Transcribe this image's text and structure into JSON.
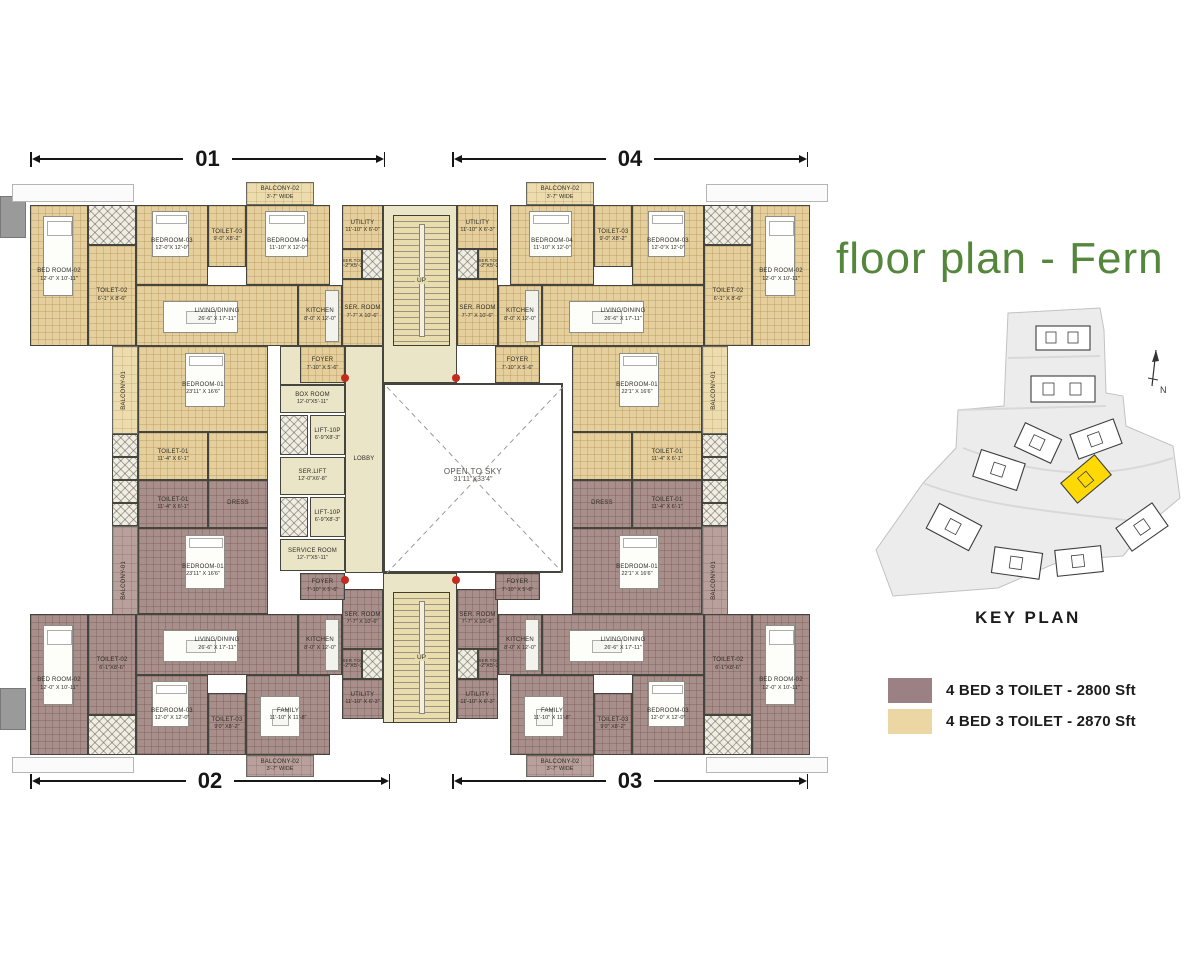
{
  "title": "floor plan - Fern",
  "title_color": "#54863c",
  "dims": {
    "top_left": "01",
    "top_right": "04",
    "bottom_left": "02",
    "bottom_right": "03"
  },
  "courtyard": {
    "name": "OPEN TO SKY",
    "dims": "31'11\"X33'4\""
  },
  "stairs_label": "UP",
  "key_plan": {
    "label": "KEY PLAN",
    "north": "N",
    "highlight_color": "#ffd903"
  },
  "legend": [
    {
      "color": "#9b8184",
      "label": "4 BED  3 TOILET -  2800 Sft"
    },
    {
      "color": "#ecd7a4",
      "label": "4 BED 3 TOILET -  2870 Sft"
    }
  ],
  "plan": {
    "rooms": [
      {
        "id": "terrace-top-left",
        "x": 12,
        "y": 184,
        "w": 122,
        "h": 18,
        "c": "ledge"
      },
      {
        "id": "terrace-top-right",
        "x": 706,
        "y": 184,
        "w": 122,
        "h": 18,
        "c": "ledge"
      },
      {
        "id": "terrace-bottom-left",
        "x": 12,
        "y": 757,
        "w": 122,
        "h": 16,
        "c": "ledge"
      },
      {
        "id": "terrace-bottom-right",
        "x": 706,
        "y": 757,
        "w": 122,
        "h": 16,
        "c": "ledge"
      },
      {
        "id": "wall-stub-left-top",
        "x": 0,
        "y": 196,
        "w": 26,
        "h": 42,
        "c": "graystub"
      },
      {
        "id": "wall-stub-left-bottom",
        "x": 0,
        "y": 688,
        "w": 26,
        "h": 42,
        "c": "graystub"
      },
      {
        "id": "core-top",
        "x": 383,
        "y": 205,
        "w": 74,
        "h": 178,
        "c": "cream"
      },
      {
        "id": "core-bottom",
        "x": 383,
        "y": 573,
        "w": 74,
        "h": 150,
        "c": "cream"
      },
      {
        "id": "lift-corridor",
        "x": 280,
        "y": 346,
        "w": 65,
        "h": 39,
        "c": "cream"
      },
      {
        "id": "u01-bed-room-02",
        "n": "BED ROOM-02",
        "d": "12'-0\" X 10'-11\"",
        "x": 30,
        "y": 205,
        "w": 58,
        "h": 141,
        "c": "tan",
        "f": "bed"
      },
      {
        "id": "u01-duct",
        "x": 88,
        "y": 205,
        "w": 48,
        "h": 40,
        "c": "hatch"
      },
      {
        "id": "u01-toilet-02",
        "n": "TOILET-02",
        "d": "6'-1\" X 8'-6\"",
        "x": 88,
        "y": 245,
        "w": 48,
        "h": 101,
        "c": "tan"
      },
      {
        "id": "u01-bedroom-03",
        "n": "BEDROOM-03",
        "d": "12'-0\"X 12'-0\"",
        "x": 136,
        "y": 205,
        "w": 72,
        "h": 80,
        "c": "tan",
        "f": "bed"
      },
      {
        "id": "u01-toilet-03",
        "n": "TOILET-03",
        "d": "9'-0\" X8'-2\"",
        "x": 208,
        "y": 205,
        "w": 38,
        "h": 62,
        "c": "tan"
      },
      {
        "id": "u01-bedroom-04",
        "n": "BEDROOM-04",
        "d": "11'-10\" X 12'-0\"",
        "x": 246,
        "y": 205,
        "w": 84,
        "h": 80,
        "c": "tan",
        "f": "bed"
      },
      {
        "id": "u01-balcony-02",
        "n": "BALCONY-02",
        "d": "3'-7\" WIDE",
        "x": 246,
        "y": 182,
        "w": 68,
        "h": 23,
        "c": "tanl"
      },
      {
        "id": "u01-living-dining",
        "n": "LIVING/DINING",
        "d": "26'-6\" X 17'-11\"",
        "x": 136,
        "y": 285,
        "w": 162,
        "h": 61,
        "c": "tan",
        "f": "sofa"
      },
      {
        "id": "u01-kitchen",
        "n": "KITCHEN",
        "d": "8'-0\" X 12'-0\"",
        "x": 298,
        "y": 285,
        "w": 44,
        "h": 61,
        "c": "tan",
        "f": "counter"
      },
      {
        "id": "u01-utility",
        "n": "UTILITY",
        "d": "11'-10\" X 6'-0\"",
        "x": 342,
        "y": 205,
        "w": 41,
        "h": 44,
        "c": "tan"
      },
      {
        "id": "u01-ser-toi",
        "n": "SER.TOI",
        "d": "2'-2\"X5'-2\"",
        "x": 342,
        "y": 249,
        "w": 20,
        "h": 30,
        "c": "tan tiny"
      },
      {
        "id": "u01-duct-2",
        "x": 362,
        "y": 249,
        "w": 21,
        "h": 30,
        "c": "hatch"
      },
      {
        "id": "u01-ser-room",
        "n": "SER. ROOM",
        "d": "7'-7\" X 10'-6\"",
        "x": 342,
        "y": 279,
        "w": 41,
        "h": 67,
        "c": "tan"
      },
      {
        "id": "u01-foyer",
        "n": "FOYER",
        "d": "7'-10\" X 5'-6\"",
        "x": 300,
        "y": 346,
        "w": 45,
        "h": 37,
        "c": "tan"
      },
      {
        "id": "u01-bedroom-01",
        "n": "BEDROOM-01",
        "d": "23'11\" X 16'6\"",
        "x": 138,
        "y": 346,
        "w": 130,
        "h": 86,
        "c": "tan",
        "f": "bedw"
      },
      {
        "id": "u01-toilet-01",
        "n": "TOILET-01",
        "d": "11'-4\" X 6'-1\"",
        "x": 138,
        "y": 432,
        "w": 70,
        "h": 48,
        "c": "tan"
      },
      {
        "id": "u01-wardrobe",
        "x": 208,
        "y": 432,
        "w": 60,
        "h": 48,
        "c": "tan"
      },
      {
        "id": "u01-balcony-01",
        "n": "BALCONY-01",
        "x": 112,
        "y": 346,
        "w": 26,
        "h": 88,
        "c": "tanl",
        "v": true
      },
      {
        "id": "u01-shaft-a",
        "x": 112,
        "y": 434,
        "w": 26,
        "h": 23,
        "c": "hatch"
      },
      {
        "id": "u01-shaft-b",
        "x": 112,
        "y": 457,
        "w": 26,
        "h": 23,
        "c": "hatch"
      },
      {
        "id": "u02-toilet-01",
        "n": "TOILET-01",
        "d": "11'-4\" X 6'-1\"",
        "x": 138,
        "y": 480,
        "w": 70,
        "h": 48,
        "c": "mauve"
      },
      {
        "id": "u02-dress",
        "n": "DRESS",
        "x": 208,
        "y": 480,
        "w": 60,
        "h": 48,
        "c": "mauve"
      },
      {
        "id": "u02-shaft-a",
        "x": 112,
        "y": 480,
        "w": 26,
        "h": 23,
        "c": "hatch"
      },
      {
        "id": "u02-shaft-b",
        "x": 112,
        "y": 503,
        "w": 26,
        "h": 23,
        "c": "hatch"
      },
      {
        "id": "u02-bedroom-01",
        "n": "BEDROOM-01",
        "d": "23'11\" X 16'6\"",
        "x": 138,
        "y": 528,
        "w": 130,
        "h": 86,
        "c": "mauve",
        "f": "bedw"
      },
      {
        "id": "u02-balcony-01",
        "n": "BALCONY-01",
        "x": 112,
        "y": 526,
        "w": 26,
        "h": 108,
        "c": "mauvel",
        "v": true
      },
      {
        "id": "u02-living-dining",
        "n": "LIVING/DINING",
        "d": "26'-6\" X 17'-11\"",
        "x": 136,
        "y": 614,
        "w": 162,
        "h": 61,
        "c": "mauve",
        "f": "sofa"
      },
      {
        "id": "u02-kitchen",
        "n": "KITCHEN",
        "d": "8'-0\" X 12'-0\"",
        "x": 298,
        "y": 614,
        "w": 44,
        "h": 61,
        "c": "mauve",
        "f": "counter"
      },
      {
        "id": "u02-bedroom-03",
        "n": "BEDROOM-03",
        "d": "12'-0\" X 12'-0\"",
        "x": 136,
        "y": 675,
        "w": 72,
        "h": 80,
        "c": "mauve",
        "f": "bed"
      },
      {
        "id": "u02-toilet-03",
        "n": "TOILET-03",
        "d": "9'0\" X8'-2\"",
        "x": 208,
        "y": 693,
        "w": 38,
        "h": 62,
        "c": "mauve"
      },
      {
        "id": "u02-family",
        "n": "FAMILY",
        "d": "11'-10\" X 11'-8\"",
        "x": 246,
        "y": 675,
        "w": 84,
        "h": 80,
        "c": "mauve",
        "f": "sofa"
      },
      {
        "id": "u02-balcony-02",
        "n": "BALCONY-02",
        "d": "3'-7\" WIDE",
        "x": 246,
        "y": 755,
        "w": 68,
        "h": 22,
        "c": "mauvel"
      },
      {
        "id": "u02-bed-room-02",
        "n": "BED ROOM-02",
        "d": "12'-0\" X 10'-11\"",
        "x": 30,
        "y": 614,
        "w": 58,
        "h": 141,
        "c": "mauve",
        "f": "bed"
      },
      {
        "id": "u02-toilet-02",
        "n": "TOILET-02",
        "d": "6'-1\"X8'-6\"",
        "x": 88,
        "y": 614,
        "w": 48,
        "h": 101,
        "c": "mauve"
      },
      {
        "id": "u02-duct",
        "x": 88,
        "y": 715,
        "w": 48,
        "h": 40,
        "c": "hatch"
      },
      {
        "id": "u02-ser-room",
        "n": "SER. ROOM",
        "d": "7'-7\" X 10'-6\"",
        "x": 342,
        "y": 589,
        "w": 41,
        "h": 60,
        "c": "mauve"
      },
      {
        "id": "u02-ser-toi",
        "n": "SER.TOI",
        "d": "2'-2\"X5'-2\"",
        "x": 342,
        "y": 649,
        "w": 20,
        "h": 30,
        "c": "mauve tiny"
      },
      {
        "id": "u02-duct-2",
        "x": 362,
        "y": 649,
        "w": 21,
        "h": 30,
        "c": "hatch"
      },
      {
        "id": "u02-utility",
        "n": "UTILITY",
        "d": "11'-10\" X 6'-3\"",
        "x": 342,
        "y": 679,
        "w": 41,
        "h": 40,
        "c": "mauve"
      },
      {
        "id": "u02-foyer",
        "n": "FOYER",
        "d": "7'-10\" X 5'-6\"",
        "x": 300,
        "y": 573,
        "w": 45,
        "h": 27,
        "c": "mauve"
      },
      {
        "id": "u04-bed-room-02",
        "n": "BED ROOM-02",
        "d": "12'-0\" X 10'-11\"",
        "x": 752,
        "y": 205,
        "w": 58,
        "h": 141,
        "c": "tan",
        "f": "bed"
      },
      {
        "id": "u04-duct",
        "x": 704,
        "y": 205,
        "w": 48,
        "h": 40,
        "c": "hatch"
      },
      {
        "id": "u04-toilet-02",
        "n": "TOILET-02",
        "d": "6'-1\" X 8'-6\"",
        "x": 704,
        "y": 245,
        "w": 48,
        "h": 101,
        "c": "tan"
      },
      {
        "id": "u04-bedroom-03",
        "n": "BEDROOM-03",
        "d": "12'-0\"X 12'-0\"",
        "x": 632,
        "y": 205,
        "w": 72,
        "h": 80,
        "c": "tan",
        "f": "bed"
      },
      {
        "id": "u04-toilet-03",
        "n": "TOILET-03",
        "d": "9'-0\" X8'-2\"",
        "x": 594,
        "y": 205,
        "w": 38,
        "h": 62,
        "c": "tan"
      },
      {
        "id": "u04-bedroom-04",
        "n": "BEDROOM-04",
        "d": "11'-10\" X 12'-0\"",
        "x": 510,
        "y": 205,
        "w": 84,
        "h": 80,
        "c": "tan",
        "f": "bed"
      },
      {
        "id": "u04-balcony-02",
        "n": "BALCONY-02",
        "d": "3'-7\" WIDE",
        "x": 526,
        "y": 182,
        "w": 68,
        "h": 23,
        "c": "tanl"
      },
      {
        "id": "u04-living-dining",
        "n": "LIVING/DINING",
        "d": "26'-6\" X 17'-11\"",
        "x": 542,
        "y": 285,
        "w": 162,
        "h": 61,
        "c": "tan",
        "f": "sofa"
      },
      {
        "id": "u04-kitchen",
        "n": "KITCHEN",
        "d": "8'-0\" X 12'-0\"",
        "x": 498,
        "y": 285,
        "w": 44,
        "h": 61,
        "c": "tan",
        "f": "counter"
      },
      {
        "id": "u04-utility",
        "n": "UTILITY",
        "d": "11'-10\" X 6'-3\"",
        "x": 457,
        "y": 205,
        "w": 41,
        "h": 44,
        "c": "tan"
      },
      {
        "id": "u04-ser-toi",
        "n": "SER.TOI",
        "d": "2'-2\"X5'-2\"",
        "x": 478,
        "y": 249,
        "w": 20,
        "h": 30,
        "c": "tan tiny"
      },
      {
        "id": "u04-duct-2",
        "x": 457,
        "y": 249,
        "w": 21,
        "h": 30,
        "c": "hatch"
      },
      {
        "id": "u04-ser-room",
        "n": "SER. ROOM",
        "d": "7'-7\" X 10'-6\"",
        "x": 457,
        "y": 279,
        "w": 41,
        "h": 67,
        "c": "tan"
      },
      {
        "id": "u04-foyer",
        "n": "FOYER",
        "d": "7'-10\" X 5'-6\"",
        "x": 495,
        "y": 346,
        "w": 45,
        "h": 37,
        "c": "tan"
      },
      {
        "id": "u04-bedroom-01",
        "n": "BEDROOM-01",
        "d": "22'1\" X 16'6\"",
        "x": 572,
        "y": 346,
        "w": 130,
        "h": 86,
        "c": "tan",
        "f": "bedw"
      },
      {
        "id": "u04-toilet-01",
        "n": "TOILET-01",
        "d": "11'-4\" X 6'-1\"",
        "x": 632,
        "y": 432,
        "w": 70,
        "h": 48,
        "c": "tan"
      },
      {
        "id": "u04-wardrobe",
        "x": 572,
        "y": 432,
        "w": 60,
        "h": 48,
        "c": "tan"
      },
      {
        "id": "u04-balcony-01",
        "n": "BALCONY-01",
        "x": 702,
        "y": 346,
        "w": 26,
        "h": 88,
        "c": "tanl",
        "v": true
      },
      {
        "id": "u04-shaft-a",
        "x": 702,
        "y": 434,
        "w": 26,
        "h": 23,
        "c": "hatch"
      },
      {
        "id": "u04-shaft-b",
        "x": 702,
        "y": 457,
        "w": 26,
        "h": 23,
        "c": "hatch"
      },
      {
        "id": "u03-toilet-01",
        "n": "TOILET-01",
        "d": "11'-4\" X 6'-1\"",
        "x": 632,
        "y": 480,
        "w": 70,
        "h": 48,
        "c": "mauve"
      },
      {
        "id": "u03-dress",
        "n": "DRESS",
        "x": 572,
        "y": 480,
        "w": 60,
        "h": 48,
        "c": "mauve"
      },
      {
        "id": "u03-shaft-a",
        "x": 702,
        "y": 480,
        "w": 26,
        "h": 23,
        "c": "hatch"
      },
      {
        "id": "u03-shaft-b",
        "x": 702,
        "y": 503,
        "w": 26,
        "h": 23,
        "c": "hatch"
      },
      {
        "id": "u03-bedroom-01",
        "n": "BEDROOM-01",
        "d": "22'1\" X 16'6\"",
        "x": 572,
        "y": 528,
        "w": 130,
        "h": 86,
        "c": "mauve",
        "f": "bedw"
      },
      {
        "id": "u03-balcony-01",
        "n": "BALCONY-01",
        "x": 702,
        "y": 526,
        "w": 26,
        "h": 108,
        "c": "mauvel",
        "v": true
      },
      {
        "id": "u03-living-dining",
        "n": "LIVING/DINING",
        "d": "26'-6\" X 17'-11\"",
        "x": 542,
        "y": 614,
        "w": 162,
        "h": 61,
        "c": "mauve",
        "f": "sofa"
      },
      {
        "id": "u03-kitchen",
        "n": "KITCHEN",
        "d": "8'-0\" X 12'-0\"",
        "x": 498,
        "y": 614,
        "w": 44,
        "h": 61,
        "c": "mauve",
        "f": "counter"
      },
      {
        "id": "u03-bedroom-03",
        "n": "BEDROOM-03",
        "d": "12'-0\" X 12'-0\"",
        "x": 632,
        "y": 675,
        "w": 72,
        "h": 80,
        "c": "mauve",
        "f": "bed"
      },
      {
        "id": "u03-toilet-03",
        "n": "TOILET-03",
        "d": "9'0\" X8'-2\"",
        "x": 594,
        "y": 693,
        "w": 38,
        "h": 62,
        "c": "mauve"
      },
      {
        "id": "u03-family",
        "n": "FAMILY",
        "d": "11'-10\" X 11'-8\"",
        "x": 510,
        "y": 675,
        "w": 84,
        "h": 80,
        "c": "mauve",
        "f": "sofa"
      },
      {
        "id": "u03-balcony-02",
        "n": "BALCONY-02",
        "d": "3'-7\" WIDE",
        "x": 526,
        "y": 755,
        "w": 68,
        "h": 22,
        "c": "mauvel"
      },
      {
        "id": "u03-bed-room-02",
        "n": "BED ROOM-02",
        "d": "12'-0\" X 10'-11\"",
        "x": 752,
        "y": 614,
        "w": 58,
        "h": 141,
        "c": "mauve",
        "f": "bed"
      },
      {
        "id": "u03-toilet-02",
        "n": "TOILET-02",
        "d": "6'-1\"X8'-6\"",
        "x": 704,
        "y": 614,
        "w": 48,
        "h": 101,
        "c": "mauve"
      },
      {
        "id": "u03-duct",
        "x": 704,
        "y": 715,
        "w": 48,
        "h": 40,
        "c": "hatch"
      },
      {
        "id": "u03-ser-room",
        "n": "SER. ROOM",
        "d": "7'-7\" X 10'-6\"",
        "x": 457,
        "y": 589,
        "w": 41,
        "h": 60,
        "c": "mauve"
      },
      {
        "id": "u03-ser-toi",
        "n": "SER.TOI",
        "d": "2'-2\"X5'-2\"",
        "x": 478,
        "y": 649,
        "w": 20,
        "h": 30,
        "c": "mauve tiny"
      },
      {
        "id": "u03-duct-2",
        "x": 457,
        "y": 649,
        "w": 21,
        "h": 30,
        "c": "hatch"
      },
      {
        "id": "u03-utility",
        "n": "UTILITY",
        "d": "11'-10\" X 6'-3\"",
        "x": 457,
        "y": 679,
        "w": 41,
        "h": 40,
        "c": "mauve"
      },
      {
        "id": "u03-foyer",
        "n": "FOYER",
        "d": "7'-10\" X 5'-6\"",
        "x": 495,
        "y": 573,
        "w": 45,
        "h": 27,
        "c": "mauve"
      },
      {
        "id": "lobby",
        "n": "LOBBY",
        "x": 345,
        "y": 346,
        "w": 38,
        "h": 227,
        "c": "cream"
      },
      {
        "id": "box-room",
        "n": "BOX ROOM",
        "d": "12'-0\"X5'-11\"",
        "x": 280,
        "y": 385,
        "w": 65,
        "h": 28,
        "c": "cream"
      },
      {
        "id": "shaft-1",
        "x": 280,
        "y": 415,
        "w": 28,
        "h": 40,
        "c": "hatch"
      },
      {
        "id": "lift-1",
        "n": "LIFT-10P",
        "d": "6'-9\"X8'-3\"",
        "x": 310,
        "y": 415,
        "w": 35,
        "h": 40,
        "c": "cream"
      },
      {
        "id": "ser-lift",
        "n": "SER.LIFT",
        "d": "12'-0\"X6'-8\"",
        "x": 280,
        "y": 457,
        "w": 65,
        "h": 38,
        "c": "cream"
      },
      {
        "id": "shaft-2",
        "x": 280,
        "y": 497,
        "w": 28,
        "h": 40,
        "c": "hatch"
      },
      {
        "id": "lift-2",
        "n": "LIFT-10P",
        "d": "6'-9\"X8'-3\"",
        "x": 310,
        "y": 497,
        "w": 35,
        "h": 40,
        "c": "cream"
      },
      {
        "id": "service-room",
        "n": "SERVICE ROOM",
        "d": "12'-7\"X5'-11\"",
        "x": 280,
        "y": 539,
        "w": 65,
        "h": 32,
        "c": "cream"
      }
    ]
  }
}
